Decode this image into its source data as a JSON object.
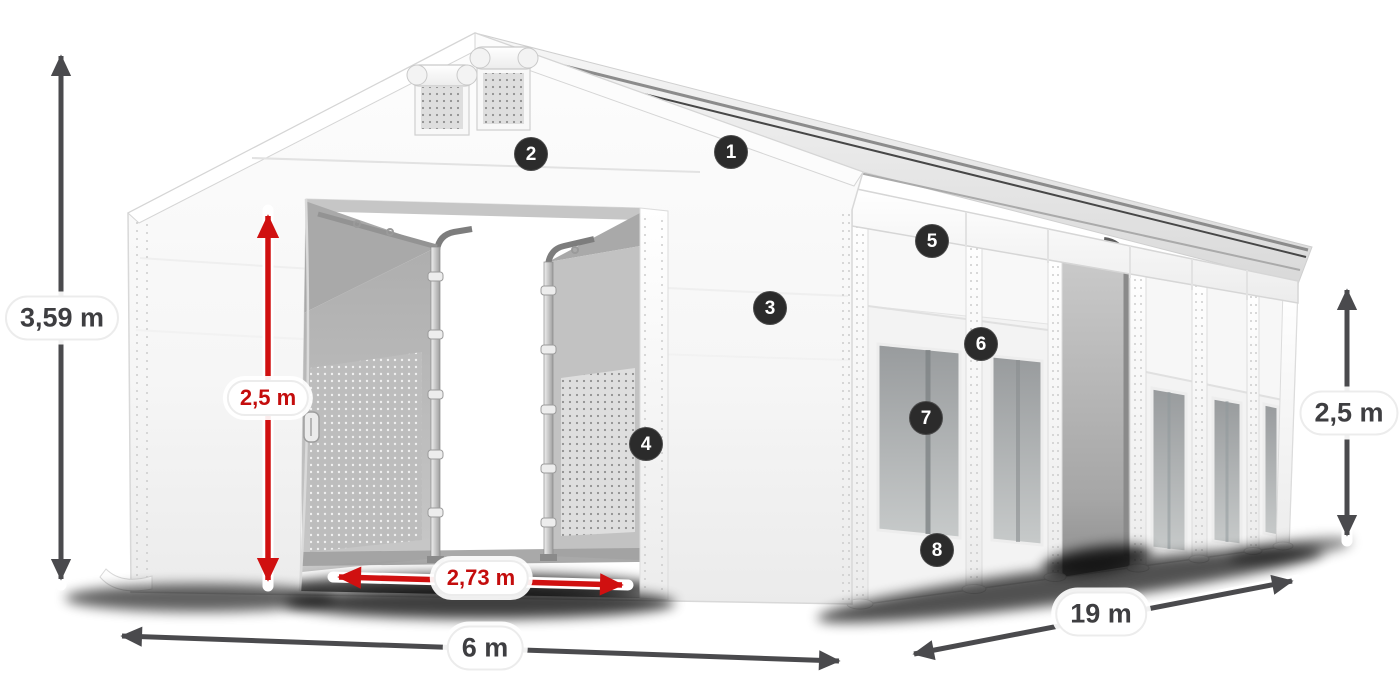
{
  "diagram": {
    "subject": "white-storage-tent-with-open-sliding-doors",
    "callouts": [
      "1",
      "2",
      "3",
      "4",
      "5",
      "6",
      "7",
      "8"
    ],
    "dimensions": {
      "total_height": "3,59 m",
      "clearance_height": "2,5 m",
      "door_width": "2,73 m",
      "width": "6 m",
      "length": "19 m",
      "side_height": "2,5 m"
    },
    "colors": {
      "accent_red": "#c40d0d",
      "arrow_gray": "#4a4a4d",
      "badge_background": "#2b2b2b",
      "tent_white": "#f6f6f6"
    }
  }
}
